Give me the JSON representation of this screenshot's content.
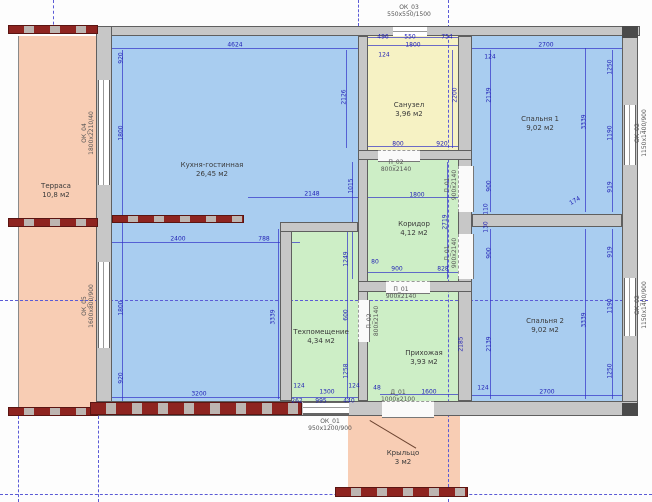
{
  "drawing_title": "floor-plan",
  "palette": {
    "room_blue": "#a9cdf0",
    "room_yellow": "#f6f2c4",
    "room_green": "#cdeec6",
    "room_pink": "#f8cdb4",
    "wall_gray": "#c7c7c7",
    "masonry_red": "#8e2420",
    "dimension_blue": "#1f1fb4",
    "axis_blue": "#5b5bd6"
  },
  "rooms": [
    {
      "name": "Терраса",
      "area": "10,8 м2"
    },
    {
      "name": "Кухня-гостинная",
      "area": "26,45 м2"
    },
    {
      "name": "Санузел",
      "area": "3,96 м2"
    },
    {
      "name": "Спальня 1",
      "area": "9,02 м2"
    },
    {
      "name": "Коридор",
      "area": "4,12 м2"
    },
    {
      "name": "Техпомещение",
      "area": "4,34 м2"
    },
    {
      "name": "Прихожая",
      "area": "3,93 м2"
    },
    {
      "name": "Спальня 2",
      "area": "9,02 м2"
    },
    {
      "name": "Крыльцо",
      "area": "3 м2"
    }
  ],
  "openings": [
    {
      "label": "ОК_03",
      "size": "550х550/1500",
      "x": 409,
      "y": 12,
      "r": 0
    },
    {
      "label": "ОК_04",
      "size": "1800х2210/40",
      "x": 89,
      "y": 133,
      "r": 1
    },
    {
      "label": "ОК_05",
      "size": "1600х800/900",
      "x": 89,
      "y": 306,
      "r": 1
    },
    {
      "label": "ОК_02",
      "size": "1150х1400/900",
      "x": 642,
      "y": 133,
      "r": 1
    },
    {
      "label": "ОК_02",
      "size": "1150х1400/900",
      "x": 642,
      "y": 305,
      "r": 1
    },
    {
      "label": "ОК_01",
      "size": "950х1200/900",
      "x": 330,
      "y": 426,
      "r": 0
    },
    {
      "label": "П_02",
      "size": "800х2140",
      "x": 396,
      "y": 167,
      "r": 0
    },
    {
      "label": "П_01",
      "size": "900х2140",
      "x": 452,
      "y": 185,
      "r": 1
    },
    {
      "label": "П_01",
      "size": "900х2140",
      "x": 452,
      "y": 253,
      "r": 1
    },
    {
      "label": "П_01",
      "size": "900х2140",
      "x": 401,
      "y": 294,
      "r": 0
    },
    {
      "label": "П_02",
      "size": "800х2140",
      "x": 374,
      "y": 321,
      "r": 1
    },
    {
      "label": "Д_01",
      "size": "1000х2100",
      "x": 398,
      "y": 397,
      "r": 0
    }
  ],
  "dimensions": [
    {
      "t": "4624",
      "x": 235,
      "y": 45
    },
    {
      "t": "496",
      "x": 383,
      "y": 37
    },
    {
      "t": "550",
      "x": 410,
      "y": 37
    },
    {
      "t": "754",
      "x": 447,
      "y": 37
    },
    {
      "t": "1800",
      "x": 413,
      "y": 45
    },
    {
      "t": "124",
      "x": 384,
      "y": 55
    },
    {
      "t": "2700",
      "x": 546,
      "y": 45
    },
    {
      "t": "124",
      "x": 490,
      "y": 57
    },
    {
      "t": "920",
      "x": 121,
      "y": 58,
      "r": 1
    },
    {
      "t": "1800",
      "x": 121,
      "y": 133,
      "r": 1
    },
    {
      "t": "1800",
      "x": 121,
      "y": 308,
      "r": 1
    },
    {
      "t": "920",
      "x": 121,
      "y": 378,
      "r": 1
    },
    {
      "t": "2126",
      "x": 344,
      "y": 97,
      "r": 1
    },
    {
      "t": "1015",
      "x": 351,
      "y": 186,
      "r": 1
    },
    {
      "t": "2148",
      "x": 312,
      "y": 194
    },
    {
      "t": "2400",
      "x": 178,
      "y": 239
    },
    {
      "t": "788",
      "x": 264,
      "y": 239
    },
    {
      "t": "3200",
      "x": 199,
      "y": 394
    },
    {
      "t": "3339",
      "x": 273,
      "y": 317,
      "r": 1
    },
    {
      "t": "2200",
      "x": 455,
      "y": 95,
      "r": 1
    },
    {
      "t": "800",
      "x": 398,
      "y": 144
    },
    {
      "t": "920",
      "x": 442,
      "y": 144
    },
    {
      "t": "2139",
      "x": 489,
      "y": 95,
      "r": 1
    },
    {
      "t": "3339",
      "x": 584,
      "y": 122,
      "r": 1
    },
    {
      "t": "1250",
      "x": 610,
      "y": 67,
      "r": 1
    },
    {
      "t": "1190",
      "x": 610,
      "y": 133,
      "r": 1
    },
    {
      "t": "919",
      "x": 610,
      "y": 187,
      "r": 1
    },
    {
      "t": "900",
      "x": 489,
      "y": 186,
      "r": 1
    },
    {
      "t": "174",
      "x": 575,
      "y": 201,
      "r": 2
    },
    {
      "t": "1800",
      "x": 417,
      "y": 195
    },
    {
      "t": "2719",
      "x": 445,
      "y": 222,
      "r": 1
    },
    {
      "t": "80",
      "x": 375,
      "y": 262
    },
    {
      "t": "900",
      "x": 397,
      "y": 269
    },
    {
      "t": "828",
      "x": 443,
      "y": 269
    },
    {
      "t": "110",
      "x": 486,
      "y": 209,
      "r": 1
    },
    {
      "t": "130",
      "x": 486,
      "y": 227,
      "r": 1
    },
    {
      "t": "1249",
      "x": 346,
      "y": 259,
      "r": 1
    },
    {
      "t": "600",
      "x": 346,
      "y": 315,
      "r": 1
    },
    {
      "t": "1258",
      "x": 346,
      "y": 371,
      "r": 1
    },
    {
      "t": "124",
      "x": 299,
      "y": 386
    },
    {
      "t": "124",
      "x": 354,
      "y": 386
    },
    {
      "t": "1300",
      "x": 327,
      "y": 392
    },
    {
      "t": "262",
      "x": 297,
      "y": 401
    },
    {
      "t": "995",
      "x": 321,
      "y": 401
    },
    {
      "t": "440",
      "x": 349,
      "y": 401
    },
    {
      "t": "2185",
      "x": 461,
      "y": 344,
      "r": 1
    },
    {
      "t": "48",
      "x": 377,
      "y": 388
    },
    {
      "t": "1600",
      "x": 429,
      "y": 392
    },
    {
      "t": "124",
      "x": 483,
      "y": 388
    },
    {
      "t": "900",
      "x": 489,
      "y": 253,
      "r": 1
    },
    {
      "t": "2139",
      "x": 489,
      "y": 344,
      "r": 1
    },
    {
      "t": "919",
      "x": 610,
      "y": 252,
      "r": 1
    },
    {
      "t": "1190",
      "x": 610,
      "y": 306,
      "r": 1
    },
    {
      "t": "1250",
      "x": 610,
      "y": 371,
      "r": 1
    },
    {
      "t": "3339",
      "x": 584,
      "y": 320,
      "r": 1
    },
    {
      "t": "2700",
      "x": 547,
      "y": 392
    }
  ]
}
